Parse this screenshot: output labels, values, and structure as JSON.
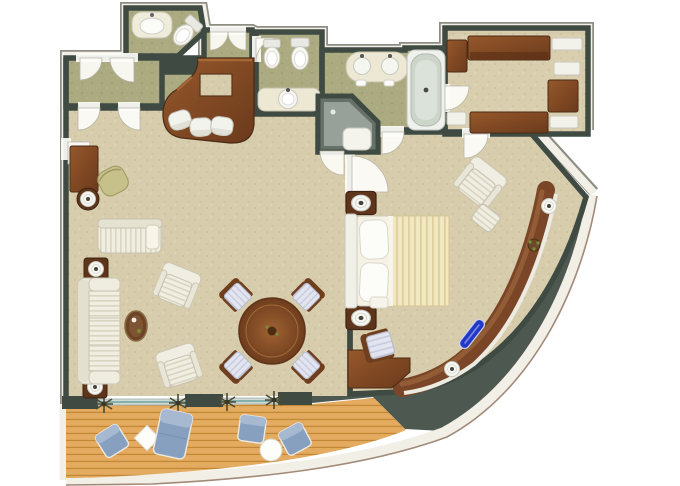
{
  "title": "Luxury suite floor plan - top-down architectural rendering with curved hull wall and private teak veranda",
  "palette": {
    "background": "#ffffff",
    "wall": "#3f4a43",
    "wall_dark": "#4d5851",
    "outer_band": "#f2efe7",
    "outer_line": "#a18b78",
    "carpet_main": "#d7ccab",
    "carpet_hall": "#abaa80",
    "carpet_closet": "#cfc5a5",
    "wood_light": "#96582b",
    "wood_dark": "#6b3a1c",
    "deck": "#e3a95d",
    "deck_line": "#c08738",
    "upholstery": "#f0eee1",
    "upholstery_line": "#d9d5c3",
    "blue_seat": "#87a0bf",
    "blue_seat_light": "#a6b9d1",
    "bed_spread": "#f1e7c0",
    "bed_stripe": "#dfcf9c",
    "fixture": "#f7f7f3",
    "shower": "#66716a",
    "accent_blue": "#2438c8",
    "olive_chair": "#c6c08b"
  },
  "rooms": [
    {
      "id": "entry-hallway",
      "label": "Entry hallway",
      "features": [
        "double-entry-doors",
        "interior-door-swings"
      ]
    },
    {
      "id": "guest-bathroom",
      "label": "Guest bathroom",
      "fixtures": [
        "vanity-sink",
        "toilet"
      ]
    },
    {
      "id": "master-wc",
      "label": "Master WC",
      "fixtures": [
        "bidet",
        "toilet",
        "vanity-sink"
      ]
    },
    {
      "id": "master-bathroom",
      "label": "Master bathroom",
      "fixtures": [
        "double-vanity",
        "corner-shower",
        "bathtub"
      ]
    },
    {
      "id": "walk-in-closet",
      "label": "Walk-in closet",
      "furniture": [
        "wardrobe-top",
        "wardrobe-bottom",
        "dresser",
        "open-shelving",
        "side-cabinet"
      ]
    },
    {
      "id": "living-room",
      "label": "Living / dining room",
      "furniture": [
        "bar-counter",
        "bar-stools-x3",
        "writing-desk",
        "desk-chair",
        "chaise-lounge",
        "sofa",
        "armchairs-x2",
        "coffee-table",
        "lamp-tables-x3",
        "round-dining-table",
        "dining-chairs-x4"
      ]
    },
    {
      "id": "bedroom",
      "label": "Master bedroom",
      "furniture": [
        "double-bed",
        "nightstands-x2",
        "table-lamps",
        "armchair-with-ottoman",
        "curved-window-console",
        "blue-glass-sculpture",
        "vanity-desk",
        "vanity-chair"
      ]
    },
    {
      "id": "balcony",
      "label": "Private veranda, teak deck",
      "furniture": [
        "lounge-chairs-x3",
        "sun-chaise",
        "square-side-table",
        "round-side-table",
        "planters-x4"
      ]
    }
  ],
  "shape_notes": {
    "hull": "white-banded curved outer wall sweeping from the upper right corner down to the lower left",
    "deck": "plank-textured wooden veranda along the bottom edge",
    "floors": "beige speckled carpet in living and bedroom, olive carpet in hallway and baths"
  }
}
